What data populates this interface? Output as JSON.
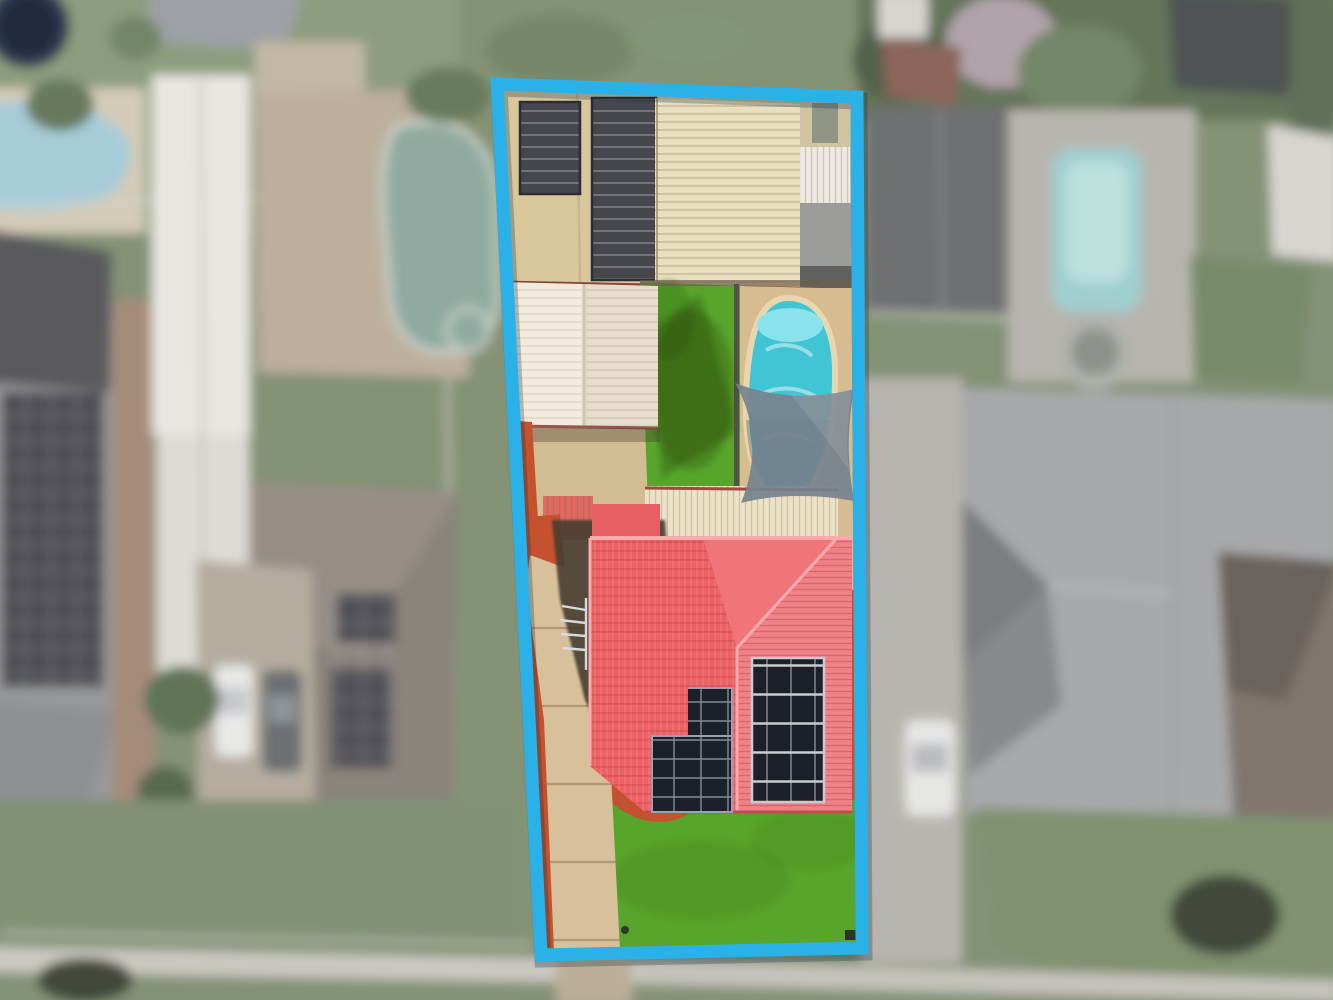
{
  "scene": {
    "kind": "aerial-drone-photograph",
    "subject": "residential-lot-highlighted-with-blue-boundary",
    "visible_features": [
      "tan shed roof with two dark pool-heater panels",
      "cream ribbed garage roof",
      "white gabled patio roof",
      "backyard lawn",
      "kidney-shaped swimming pool",
      "grey shade sail",
      "cream pergola strip",
      "red tiled hip roof house",
      "two rooftop solar panel arrays",
      "tv antenna",
      "red mulch garden beds with cream concrete edging",
      "front lawn",
      "concrete driveway",
      "blurred neighbour houses, pools and street"
    ]
  },
  "boundary": {
    "points": "497,84 857,97 862,948 541,955",
    "stroke_width": 13,
    "color": "#2ab1e8"
  },
  "colors": {
    "boundary": "#2ab1e8",
    "lawn": "#58a52b",
    "lawn_dark": "#3f7d1e",
    "mulch": "#c5522e",
    "edging": "#ead9a8",
    "driveway": "#d8c19a",
    "paving": "#d2bc92",
    "deck": "#d6bc90",
    "roof_red": "#ed6b6f",
    "roof_red_left": "#ec6165",
    "roof_red_pink": "#f08186",
    "roof_ridge": "#f7abad",
    "roof_tan": "#d9c79c",
    "roof_cream": "#e9dec0",
    "roof_white": "#f2ebdd",
    "pergola": "#ece2c6",
    "heater_panel": "#45474d",
    "solar_dark": "#1c2028",
    "solar_grid": "#8b93a0",
    "pool_water": "#41c4d4",
    "pool_light": "#8ae2ec",
    "sail": "#76828e",
    "shadow": "#463c33",
    "bg_lawn": "#7f9464",
    "bg_roof_gray": "#a8a9ab",
    "bg_roof_dark": "#595a60",
    "bg_roof_brown": "#8f8377",
    "bg_roof_tile": "#857567",
    "bg_pool": "#7fd4d4",
    "bg_pool_green": "#7fae9e",
    "bg_concrete": "#b9b5ac",
    "bg_tree": "#5d7847"
  }
}
